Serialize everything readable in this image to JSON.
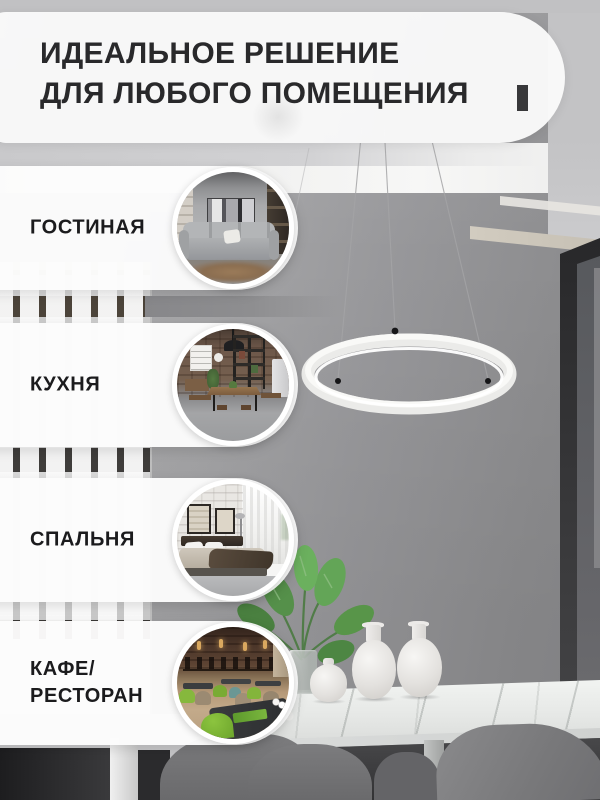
{
  "banner": {
    "title": "ИДЕАЛЬНОЕ РЕШЕНИЕ\nДЛЯ ЛЮБОГО ПОМЕЩЕНИЯ"
  },
  "badges": [
    {
      "label": "ГОСТИНАЯ",
      "scene": "living-room-photo"
    },
    {
      "label": "КУХНЯ",
      "scene": "kitchen-dining-photo"
    },
    {
      "label": "СПАЛЬНЯ",
      "scene": "bedroom-photo"
    },
    {
      "label": "КАФЕ/\nРЕСТОРАН",
      "scene": "cafe-restaurant-photo"
    }
  ],
  "scene": {
    "product": "white ring LED pendant lamp on three cables",
    "setting": "grey dining room: marble table, three white vases, monstera plant, grey chairs, white column radiator, dark window frame"
  },
  "palette": {
    "banner_bg": "#FAFAFA",
    "title_text": "#29292B",
    "label_text": "#1B1B1D",
    "wall_grey": "#98989A",
    "lamp_white": "#F5F5F3",
    "plant_green": "#5D9850",
    "cafe_chair_green": "#7FBF3A"
  }
}
